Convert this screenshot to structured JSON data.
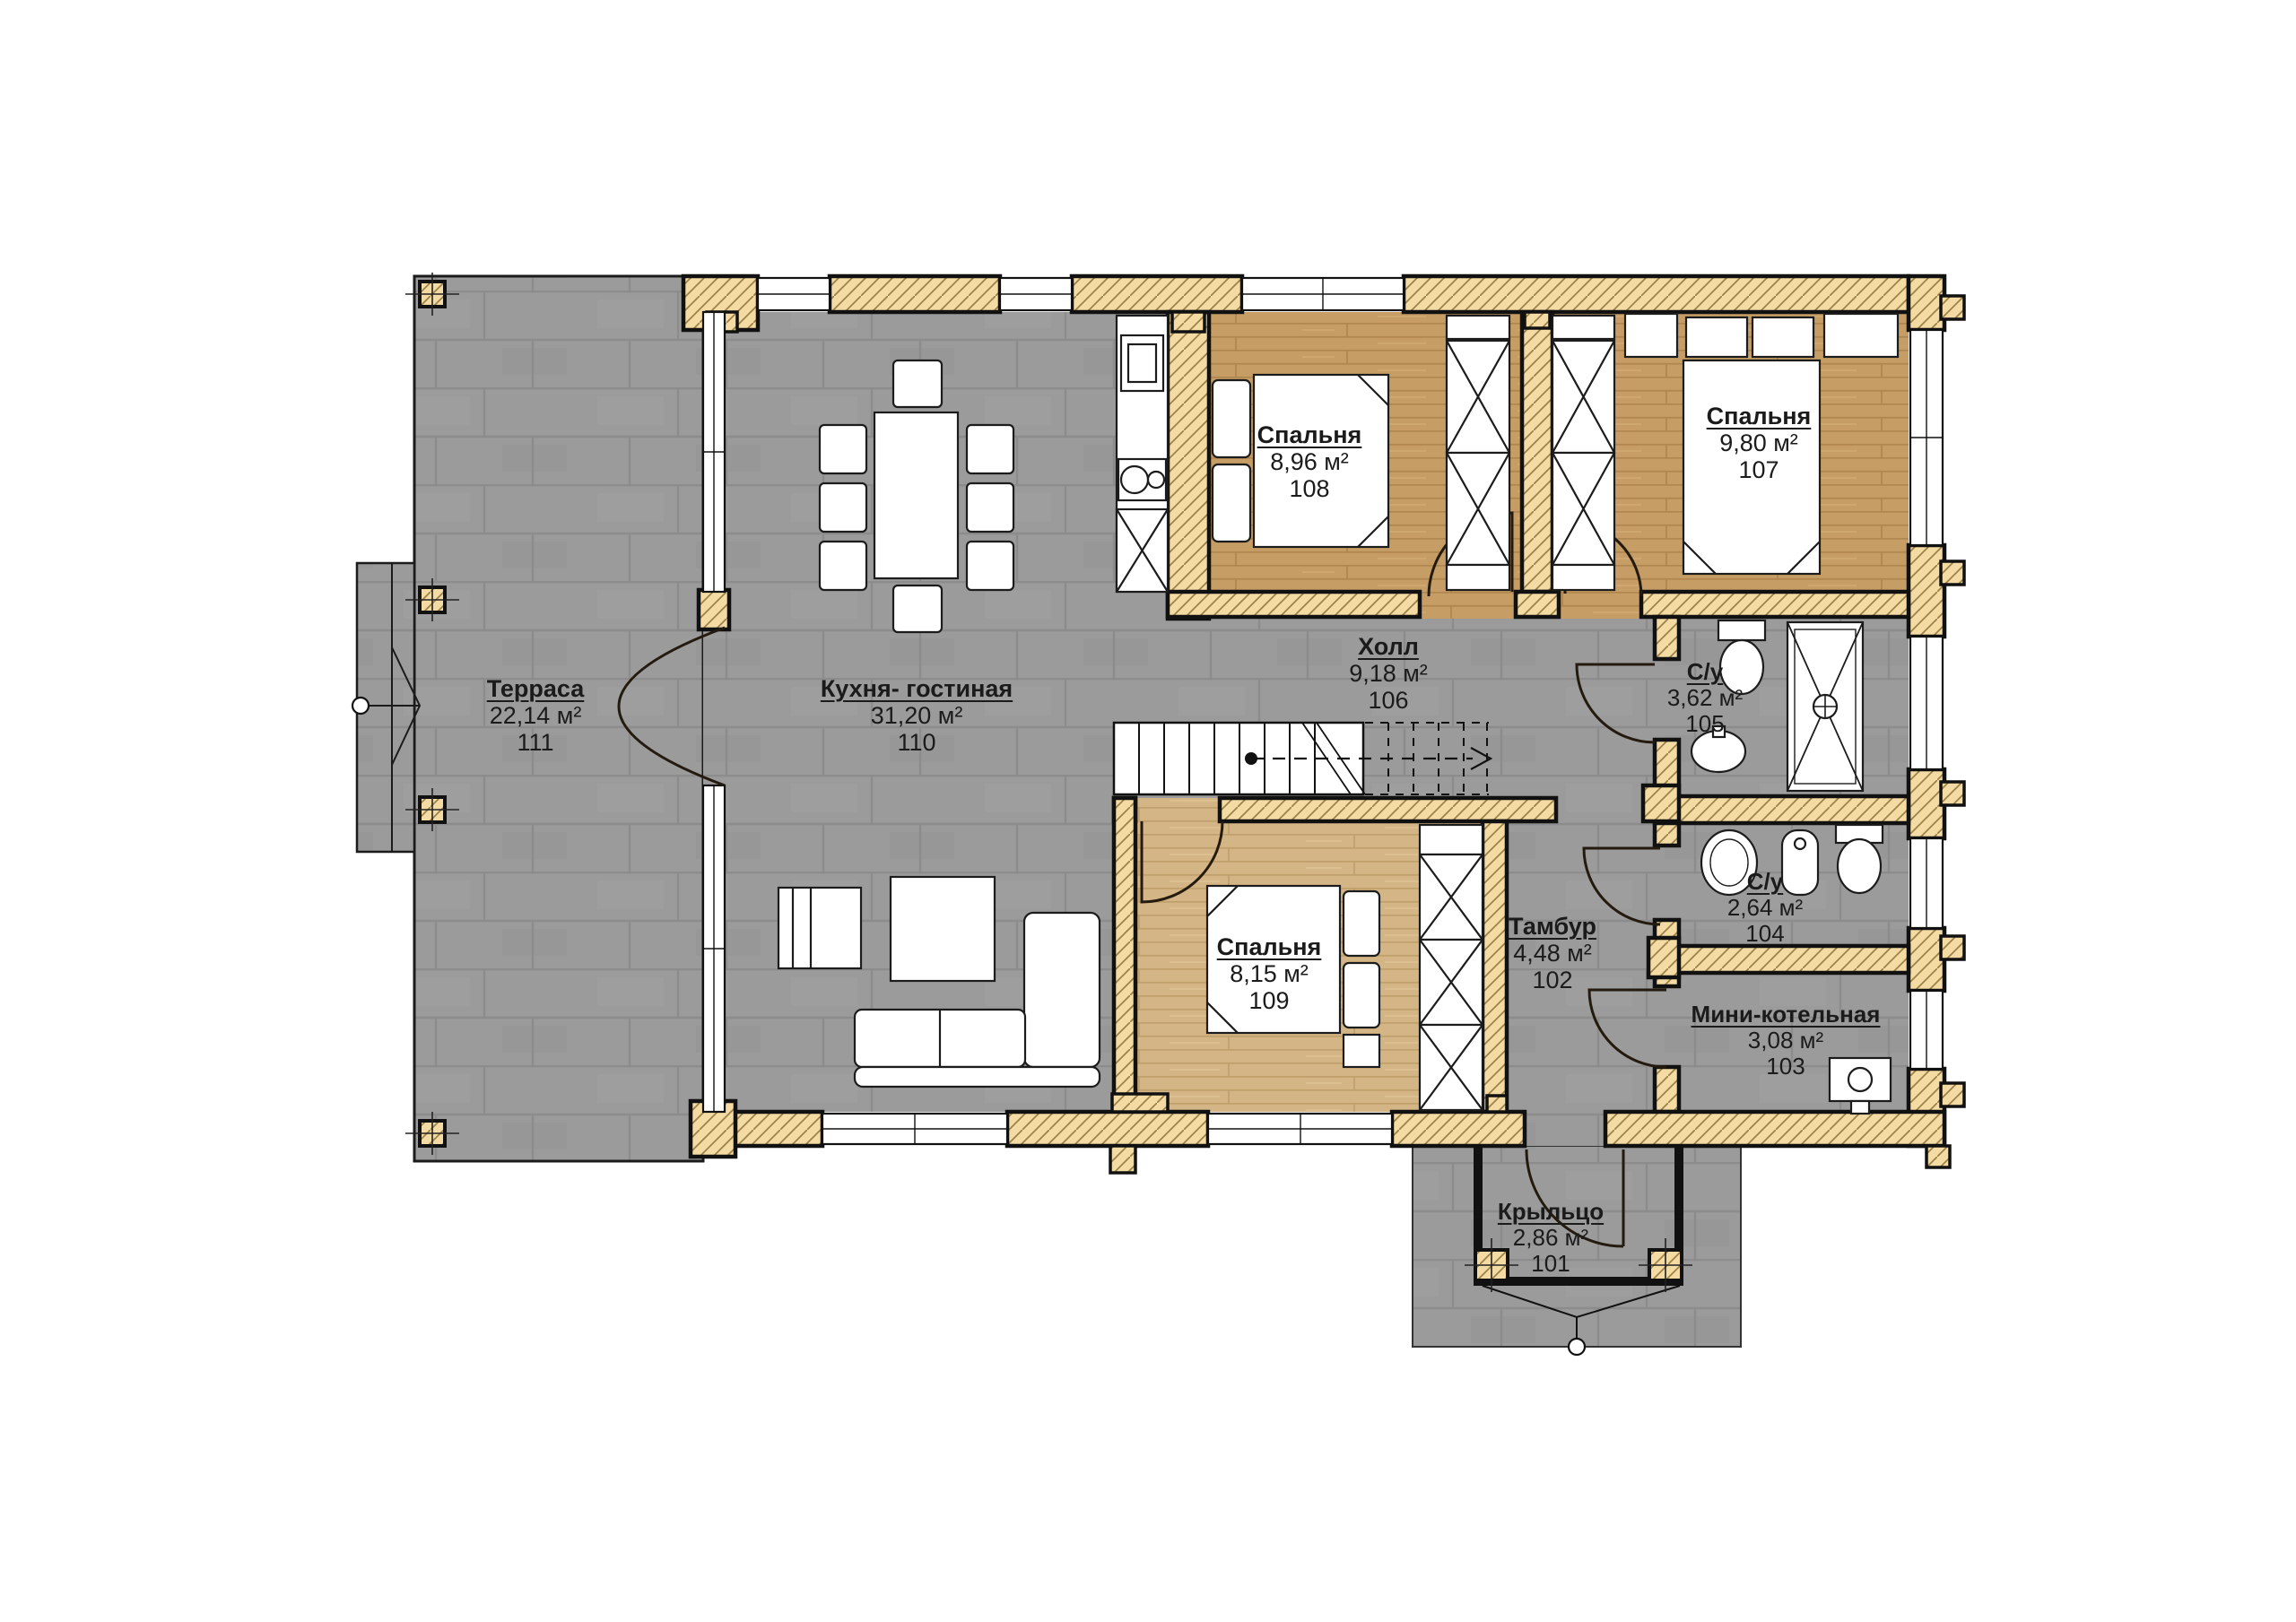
{
  "plan_type": "floor-plan",
  "rooms": [
    {
      "number": "101",
      "name": "Крыльцо",
      "area": "2,86 м²"
    },
    {
      "number": "102",
      "name": "Тамбур",
      "area": "4,48 м²"
    },
    {
      "number": "103",
      "name": "Мини-котельная",
      "area": "3,08 м²"
    },
    {
      "number": "104",
      "name": "С/у",
      "area": "2,64 м²"
    },
    {
      "number": "105",
      "name": "С/у",
      "area": "3,62 м²"
    },
    {
      "number": "106",
      "name": "Холл",
      "area": "9,18 м²"
    },
    {
      "number": "107",
      "name": "Спальня",
      "area": "9,80 м²"
    },
    {
      "number": "108",
      "name": "Спальня",
      "area": "8,96 м²"
    },
    {
      "number": "109",
      "name": "Спальня",
      "area": "8,15 м²"
    },
    {
      "number": "110",
      "name": "Кухня- гостиная",
      "area": "31,20 м²"
    },
    {
      "number": "111",
      "name": "Терраса",
      "area": "22,14 м²"
    }
  ],
  "palette": {
    "background": "#ffffff",
    "tile_floor": "#9b9b9b",
    "wood_floor": "#c69d65",
    "wood_floor_light": "#d4b686",
    "log_wall": "#f3dba3",
    "line": "#111111"
  }
}
